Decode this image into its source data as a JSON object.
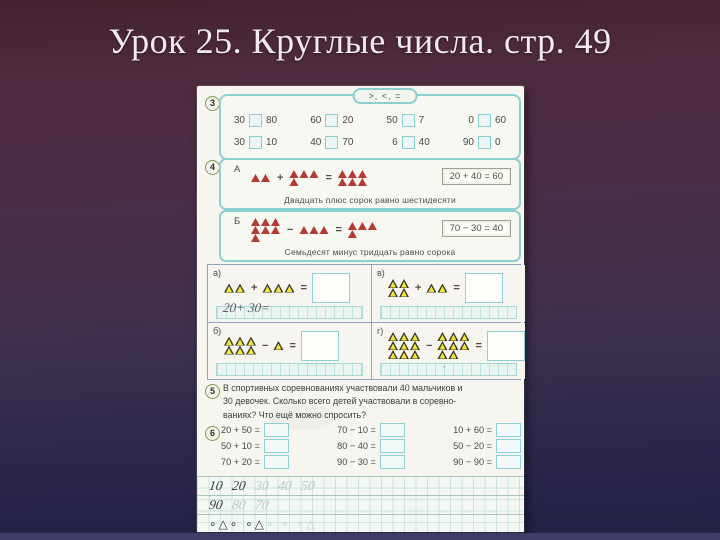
{
  "slide": {
    "title": "Урок 25. Круглые числа. стр. 49"
  },
  "symbols": {
    "plus": "+",
    "minus": "−",
    "equals": "="
  },
  "page": {
    "ex3": {
      "number": "3",
      "pill": ">, <, =",
      "rows": [
        [
          {
            "l": "30",
            "r": "80"
          },
          {
            "l": "60",
            "r": "20"
          },
          {
            "l": "50",
            "r": "7"
          },
          {
            "l": "0",
            "r": "60"
          }
        ],
        [
          {
            "l": "30",
            "r": "10"
          },
          {
            "l": "40",
            "r": "70"
          },
          {
            "l": "6",
            "r": "40"
          },
          {
            "l": "90",
            "r": "0"
          }
        ]
      ]
    },
    "ex4": {
      "number": "4",
      "a": {
        "label": "А",
        "op": "+",
        "g1": [
          2
        ],
        "g2": [
          3,
          1
        ],
        "g3": [
          3,
          3
        ],
        "equation": "20 + 40 = 60",
        "caption": "Двадцать плюс сорок равно шестидесяти"
      },
      "b": {
        "label": "Б",
        "op": "−",
        "g1": [
          3,
          3,
          1
        ],
        "g2": [
          3
        ],
        "g3": [
          3,
          1
        ],
        "equation": "70 − 30 = 40",
        "caption": "Семьдесят минус тридцать равно сорока"
      }
    },
    "quad": {
      "a": {
        "label": "а)",
        "op": "+",
        "g1": [
          2
        ],
        "g2": [
          3
        ],
        "hand": "20+ 30="
      },
      "v": {
        "label": "в)",
        "op": "+",
        "g1": [
          2,
          2
        ],
        "g2": [
          2
        ],
        "hand": ""
      },
      "b": {
        "label": "б)",
        "op": "−",
        "g1": [
          3,
          3
        ],
        "g2": [
          1
        ],
        "hand": ""
      },
      "g": {
        "label": "г)",
        "op": "−",
        "g1": [
          3,
          3,
          3
        ],
        "g2": [
          3,
          3,
          2
        ],
        "hand": "·"
      }
    },
    "ex5": {
      "number": "5",
      "lines": [
        "В спортивных соревнованиях участвовали 40 мальчиков и",
        "30 девочек. Сколько всего детей участвовали в соревно-",
        "ваниях? Что ещё можно спросить?"
      ]
    },
    "ex6": {
      "number": "6",
      "columns": [
        [
          "20 + 50 =",
          "50 + 10 =",
          "70 + 20 ="
        ],
        [
          "70 − 10 =",
          "80 − 40 =",
          "90 − 30 ="
        ],
        [
          "10 + 60 =",
          "50 − 20 =",
          "90 − 90 ="
        ]
      ]
    },
    "grid": {
      "row1": [
        "10",
        "20",
        "30",
        "40",
        "50"
      ],
      "row2": [
        "90",
        "80",
        "70"
      ],
      "pattern_dark": "∘△∘ ∘△",
      "pattern_faint": "∘ ∘ ∘△"
    }
  }
}
